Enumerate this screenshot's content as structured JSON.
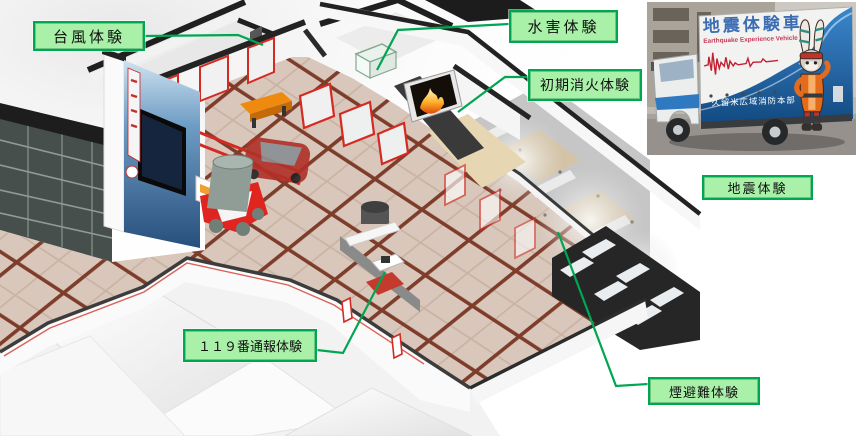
{
  "labels": {
    "typhoon": "台風体験",
    "flood": "水害体験",
    "initial_fire": "初期消火体験",
    "earthquake": "地震体験",
    "emergency_call": "１１９番通報体験",
    "smoke_evacuation": "煙避難体験"
  },
  "vehicle_photo": {
    "name_jp": "地震体験車",
    "name_en": "Earthquake Experience Vehicle",
    "organization": "久留米広域消防本部"
  },
  "colors": {
    "label_background": "#a9f1a9",
    "label_border": "#00a651",
    "leader_line": "#00a651",
    "floor_tile": "#d8c7ba",
    "tile_grid": "#7e3c2b",
    "wall_top": "#2b2b2b",
    "accent_red": "#d42a22",
    "truck_blue": "#2f79c0",
    "bench_orange": "#ef8a10",
    "flame_orange": "#ff9a1f"
  }
}
